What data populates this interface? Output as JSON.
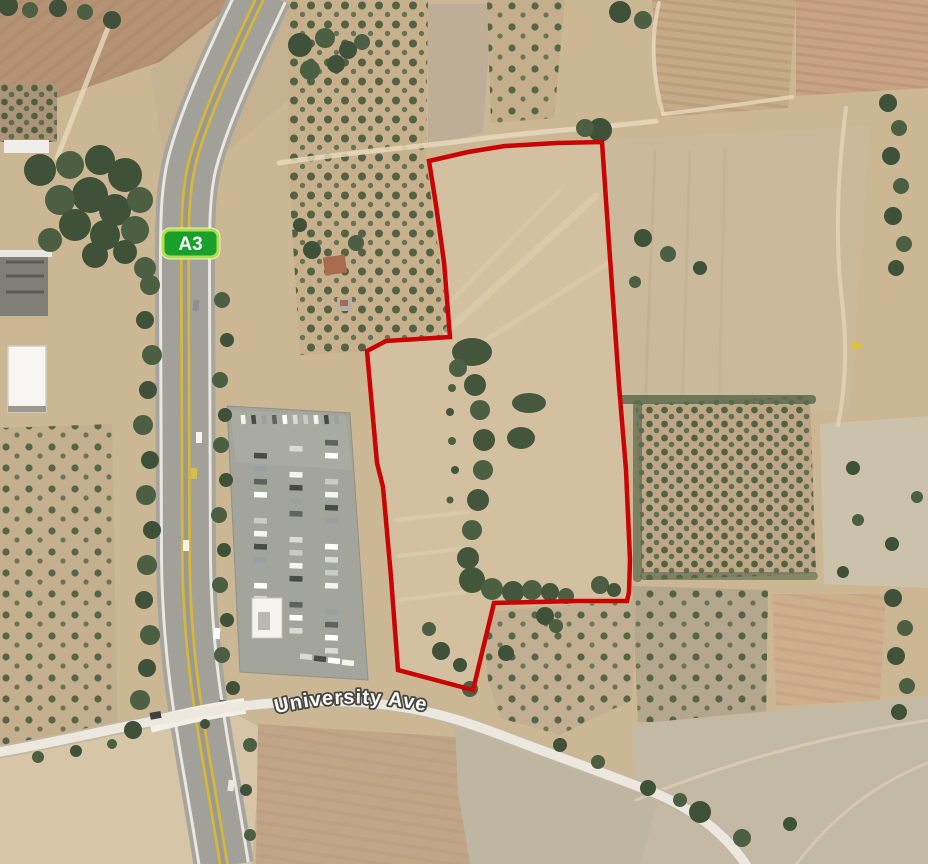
{
  "map": {
    "view": "satellite-aerial-imagery",
    "labels": {
      "route_badge": "A3",
      "road_name": "University Ave"
    },
    "colors": {
      "parcel_outline": "#ca0404",
      "badge_fill": "#17a12c",
      "badge_border": "#b5dd48",
      "badge_text": "#ffffff",
      "road_label_fill": "#ffffff",
      "road_label_outline": "#46463f",
      "terrain_base": "#ccb795",
      "highway_surface": "#a6a59d",
      "highway_median": "#d6b63c",
      "highway_edge": "#e9e7df",
      "minor_road": "#ece8de",
      "minor_road_casing": "#c2b8a3",
      "parking_surface": "#a3a59d",
      "vegetation": "#44563c",
      "parcel_field": "#d3c0a1"
    },
    "parcel_boundary_px": [
      [
        429,
        161
      ],
      [
        468,
        152
      ],
      [
        505,
        146
      ],
      [
        557,
        143
      ],
      [
        602,
        142
      ],
      [
        607,
        215
      ],
      [
        613,
        300
      ],
      [
        619,
        385
      ],
      [
        626,
        470
      ],
      [
        630,
        560
      ],
      [
        629,
        592
      ],
      [
        627,
        601
      ],
      [
        578,
        601
      ],
      [
        494,
        603
      ],
      [
        473,
        690
      ],
      [
        398,
        670
      ],
      [
        391,
        577
      ],
      [
        383,
        487
      ],
      [
        377,
        463
      ],
      [
        367,
        351
      ],
      [
        386,
        341
      ],
      [
        450,
        337
      ],
      [
        444,
        262
      ],
      [
        436,
        205
      ]
    ]
  }
}
